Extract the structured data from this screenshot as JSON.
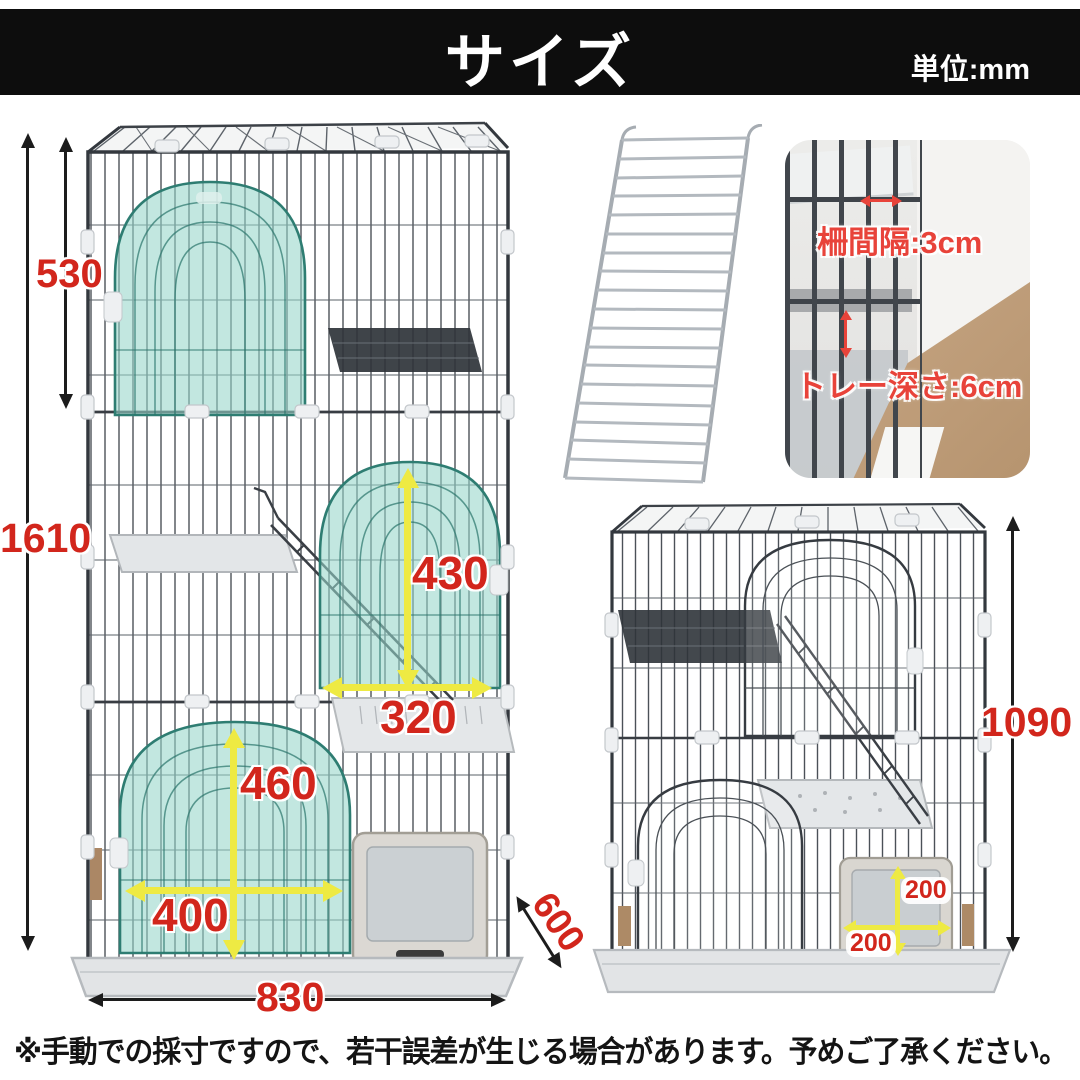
{
  "header": {
    "title": "サイズ",
    "unit_label": "単位:mm"
  },
  "left_cage": {
    "total_height": "1610",
    "upper_section_height": "530",
    "middle_door_height": "430",
    "middle_door_width": "320",
    "lower_door_height": "460",
    "lower_door_width": "400",
    "base_width": "830",
    "base_depth": "600"
  },
  "detail_photo": {
    "bar_spacing_label": "柵間隔:3cm",
    "tray_depth_label": "トレー深さ:6cm"
  },
  "right_cage": {
    "cage_height": "1090",
    "flap_height": "200",
    "flap_width": "200"
  },
  "footer": {
    "disclaimer": "※手動での採寸ですので、若干誤差が生じる場合があります。予めご了承ください。"
  },
  "colors": {
    "accent_red": "#d2261c",
    "photo_red": "#e8433a",
    "arrow_yellow": "#eeea43",
    "door_teal": "#96d6ca",
    "header_bg": "#0d0d0d"
  }
}
